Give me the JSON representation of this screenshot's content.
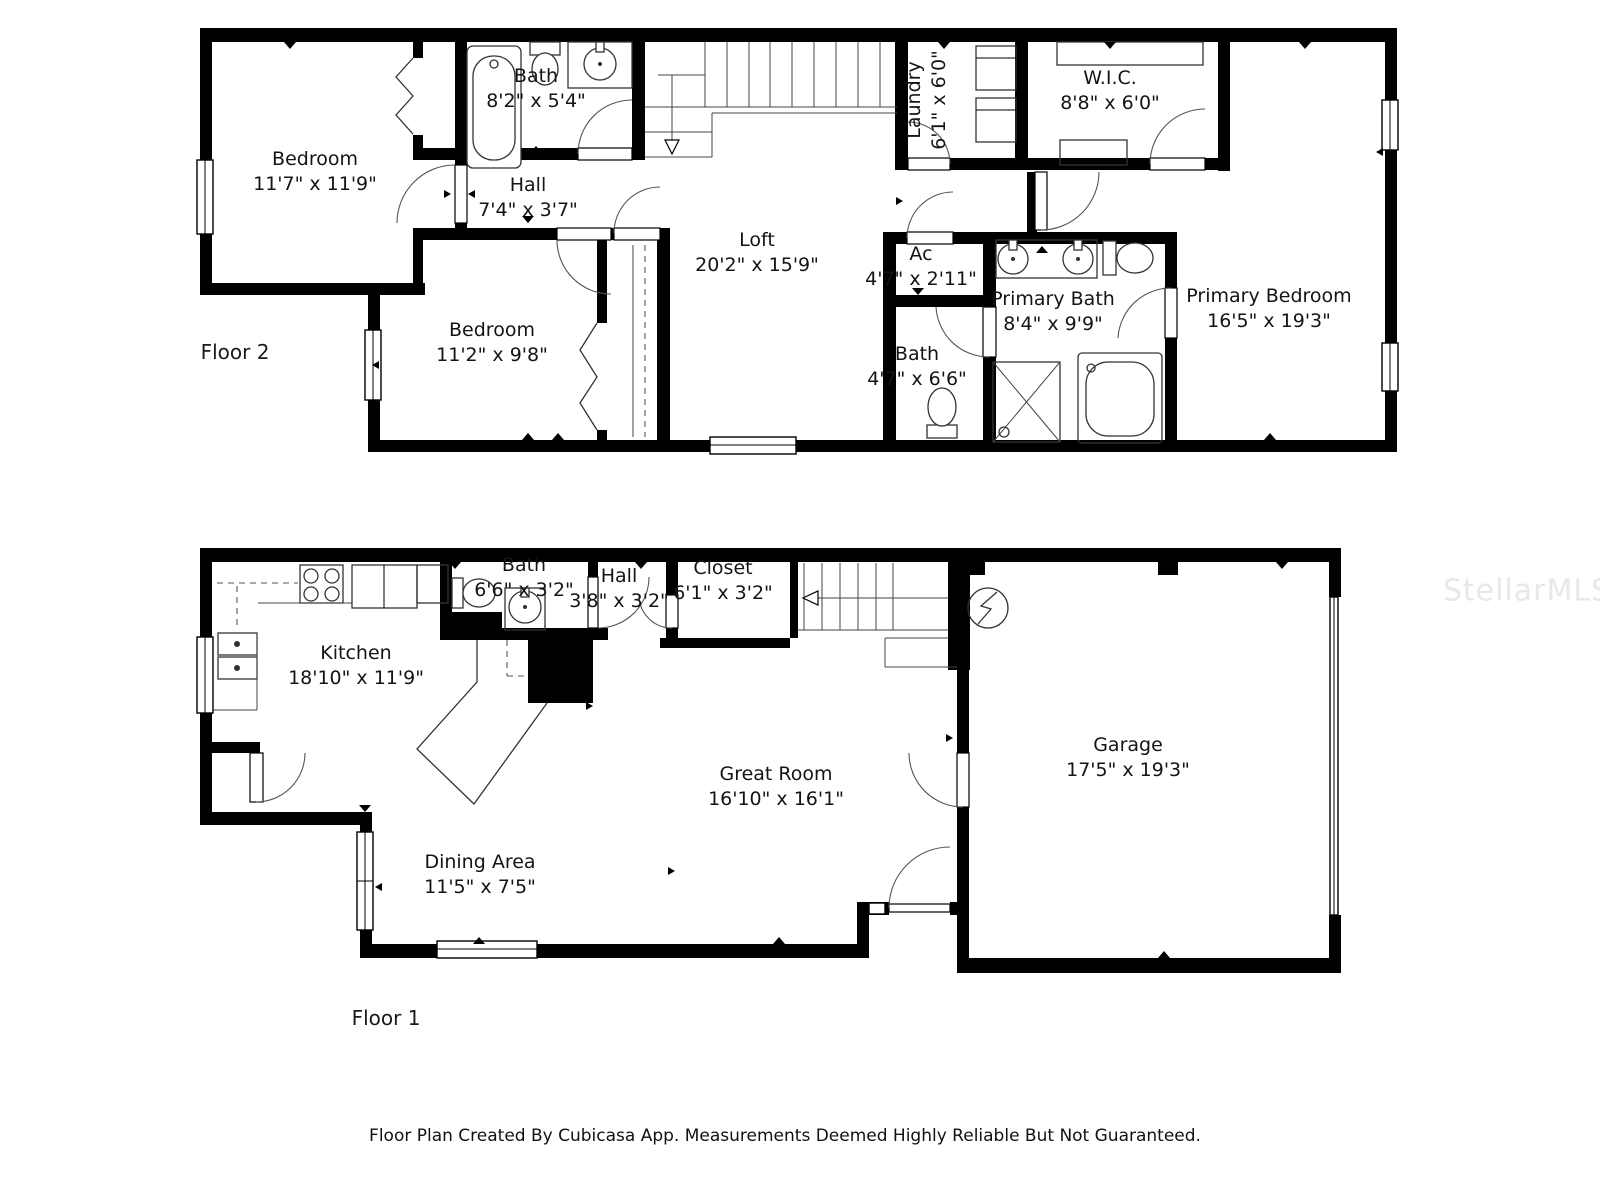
{
  "meta": {
    "footer": "Floor Plan Created By Cubicasa App. Measurements Deemed Highly Reliable But Not Guaranteed.",
    "watermark": "StellarMLS"
  },
  "floor2": {
    "label": "Floor 2",
    "rooms": [
      {
        "name": "Bedroom",
        "dims": "11'7\" x 11'9\""
      },
      {
        "name": "Bath",
        "dims": "8'2\" x 5'4\""
      },
      {
        "name": "Hall",
        "dims": "7'4\" x 3'7\""
      },
      {
        "name": "Laundry",
        "dims": "6'1\" x 6'0\""
      },
      {
        "name": "W.I.C.",
        "dims": "8'8\" x 6'0\""
      },
      {
        "name": "Loft",
        "dims": "20'2\" x 15'9\""
      },
      {
        "name": "Ac",
        "dims": "4'7\" x 2'11\""
      },
      {
        "name": "Primary Bath",
        "dims": "8'4\" x 9'9\""
      },
      {
        "name": "Bath",
        "dims": "4'7\" x 6'6\""
      },
      {
        "name": "Bedroom",
        "dims": "11'2\" x 9'8\""
      },
      {
        "name": "Primary Bedroom",
        "dims": "16'5\" x 19'3\""
      }
    ]
  },
  "floor1": {
    "label": "Floor 1",
    "rooms": [
      {
        "name": "Kitchen",
        "dims": "18'10\" x 11'9\""
      },
      {
        "name": "Bath",
        "dims": "6'6\" x 3'2\""
      },
      {
        "name": "Hall",
        "dims": "3'8\" x 3'2\""
      },
      {
        "name": "Closet",
        "dims": "6'1\" x 3'2\""
      },
      {
        "name": "Great Room",
        "dims": "16'10\" x 16'1\""
      },
      {
        "name": "Dining Area",
        "dims": "11'5\" x 7'5\""
      },
      {
        "name": "Garage",
        "dims": "17'5\" x 19'3\""
      }
    ]
  }
}
